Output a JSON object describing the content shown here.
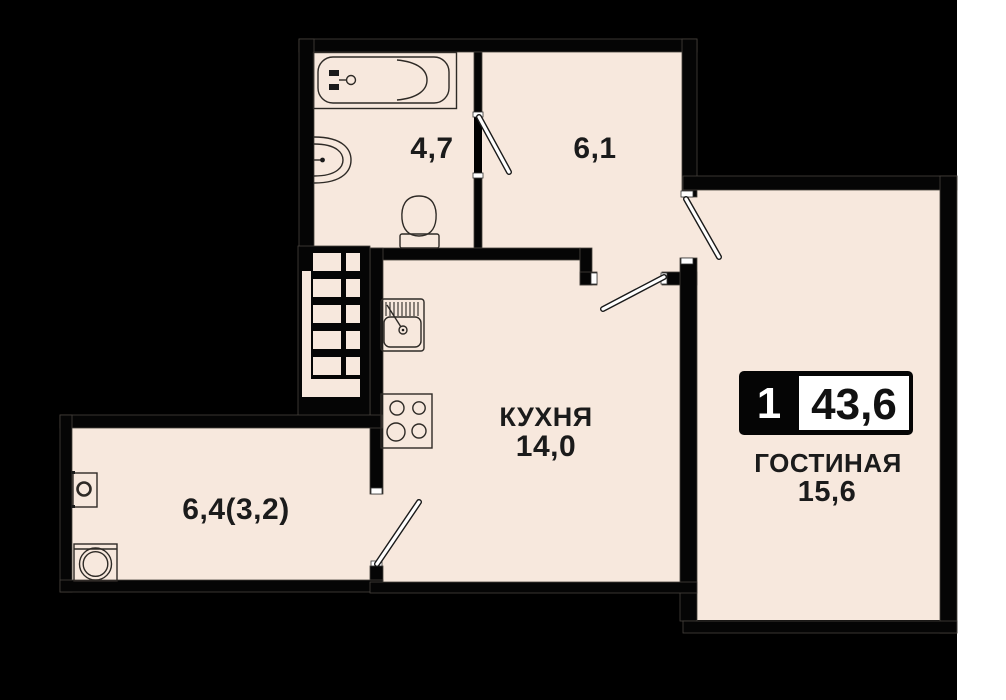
{
  "plan_type": "apartment-floor-plan",
  "badge": {
    "rooms_count": "1",
    "total_area": "43,6"
  },
  "rooms": [
    {
      "id": "bathroom",
      "label": "",
      "area": "4,7",
      "fixtures": [
        "bathtub",
        "wash-basin",
        "toilet"
      ]
    },
    {
      "id": "hallway",
      "label": "",
      "area": "6,1",
      "fixtures": []
    },
    {
      "id": "kitchen",
      "label": "КУХНЯ",
      "area": "14,0",
      "fixtures": [
        "kitchen-sink",
        "stove"
      ]
    },
    {
      "id": "living-room",
      "label": "ГОСТИНАЯ",
      "area": "15,6",
      "fixtures": []
    },
    {
      "id": "balcony",
      "label": "",
      "area": "6,4(3,2)",
      "fixtures": [
        "washing-machine",
        "water-heater"
      ]
    }
  ],
  "colors": {
    "floor": "#f7e8dd",
    "walls": "#050505",
    "canvas_background": "#000000",
    "page_margin": "#ffffff",
    "door_leaf": "#ffffff",
    "badge_background": "#050505",
    "badge_value_box": "#ffffff",
    "label_text": "#1b1b1b"
  }
}
